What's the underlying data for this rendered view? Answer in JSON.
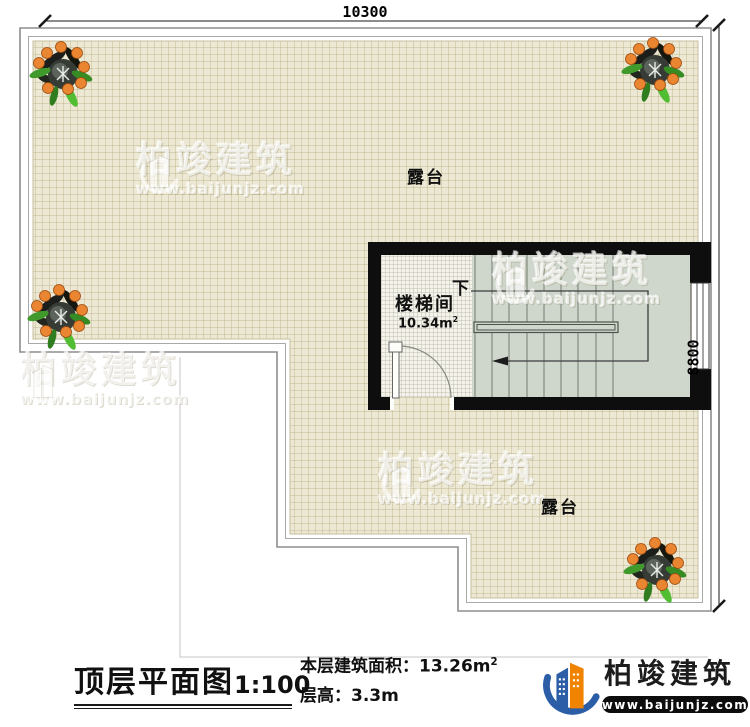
{
  "dimensions": {
    "top": "10300",
    "right": "8800"
  },
  "rooms": {
    "terrace_top": "露台",
    "terrace_bottom": "露台",
    "stairwell": "楼梯间",
    "stairwell_area": "10.34m",
    "stairwell_area_sup": "2",
    "down": "下"
  },
  "title_block": {
    "title": "顶层平面图",
    "scale": "1:100",
    "area_label": "本层建筑面积：",
    "area_value": "13.26m",
    "area_sup": "2",
    "floor_height_label": "层高：",
    "floor_height_value": "3.3m"
  },
  "brand": {
    "name": "柏竣建筑",
    "url": "www.baijunjz.com"
  },
  "watermark": {
    "name": "柏竣建筑",
    "url": "www.baijunjz.com"
  },
  "colors": {
    "terrace": "#ece8d3",
    "stairs": "#cfd6cc",
    "wall": "#111111",
    "brand_blue": "#2b5ea7",
    "brand_orange": "#f08300"
  }
}
